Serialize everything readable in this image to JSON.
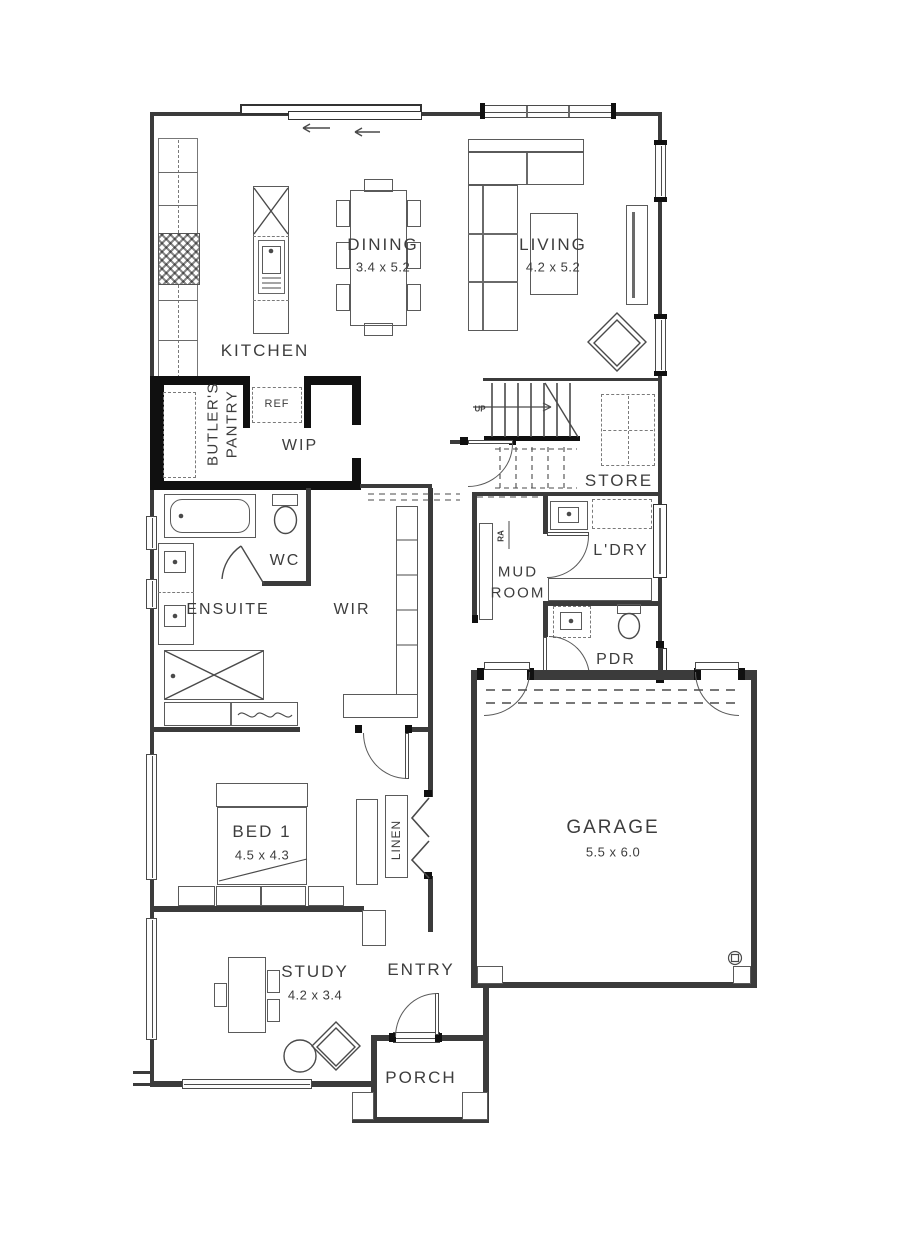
{
  "palette": {
    "line": "#4a4a4a",
    "wall": "#3b3b3b",
    "black_wall": "#101010",
    "label": "#3d3d3d",
    "background": "#ffffff"
  },
  "labels": {
    "kitchen": {
      "name": "KITCHEN"
    },
    "dining": {
      "name": "DINING",
      "dims": "3.4 x 5.2"
    },
    "living": {
      "name": "LIVING",
      "dims": "4.2 x 5.2"
    },
    "butlers_pantry": {
      "line1": "BUTLER'S",
      "line2": "PANTRY"
    },
    "ref": {
      "name": "REF"
    },
    "wip": {
      "name": "WIP"
    },
    "stairs": {
      "up": "UP"
    },
    "store": {
      "name": "STORE"
    },
    "wc": {
      "name": "WC"
    },
    "ensuite": {
      "name": "ENSUITE"
    },
    "wir": {
      "name": "WIR"
    },
    "mud_room": {
      "line1": "MUD",
      "line2": "ROOM"
    },
    "laundry": {
      "name": "L'DRY"
    },
    "ra": {
      "name": "RA"
    },
    "pdr": {
      "name": "PDR"
    },
    "bed1": {
      "name": "BED 1",
      "dims": "4.5 x 4.3"
    },
    "linen": {
      "name": "LINEN"
    },
    "garage": {
      "name": "GARAGE",
      "dims": "5.5 x 6.0"
    },
    "study": {
      "name": "STUDY",
      "dims": "4.2 x 3.4"
    },
    "entry": {
      "name": "ENTRY"
    },
    "porch": {
      "name": "PORCH"
    }
  }
}
